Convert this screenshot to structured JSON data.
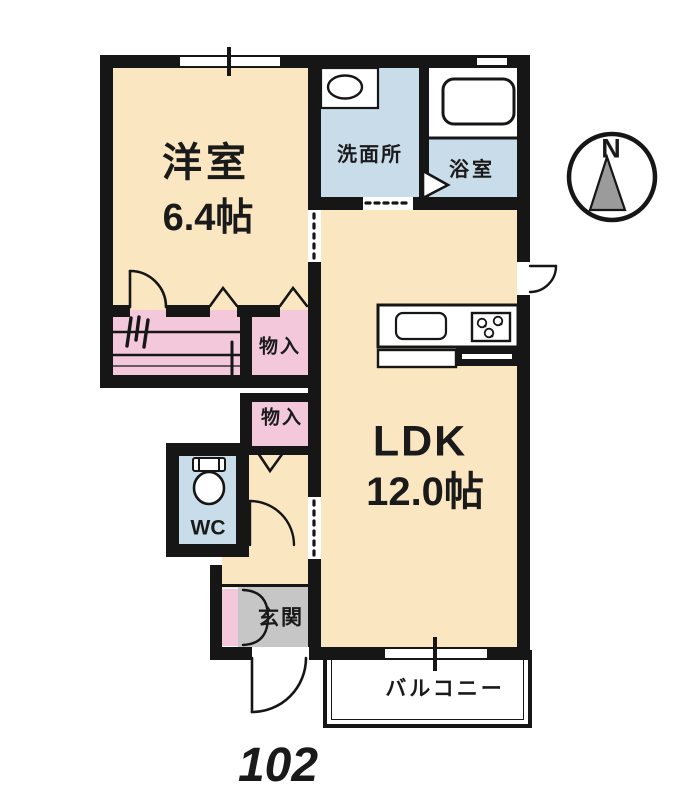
{
  "unit": {
    "number": "102"
  },
  "compass": {
    "north_label": "N"
  },
  "rooms": {
    "western_room": {
      "name": "洋室",
      "size": "6.4帖"
    },
    "washroom": {
      "name": "洗面所"
    },
    "bathroom": {
      "name": "浴室"
    },
    "ldk": {
      "name": "LDK",
      "size": "12.0帖"
    },
    "storage1": {
      "name": "物入"
    },
    "storage2": {
      "name": "物入"
    },
    "wc": {
      "name": "WC"
    },
    "entrance": {
      "name": "玄関"
    },
    "balcony": {
      "name": "バルコニー"
    }
  },
  "colors": {
    "room_cream": "#fae7c2",
    "wet_area_blue": "#c9dce9",
    "closet_pink": "#f3c8da",
    "entrance_gray": "#c6c6c6",
    "wall_black": "#161616"
  }
}
